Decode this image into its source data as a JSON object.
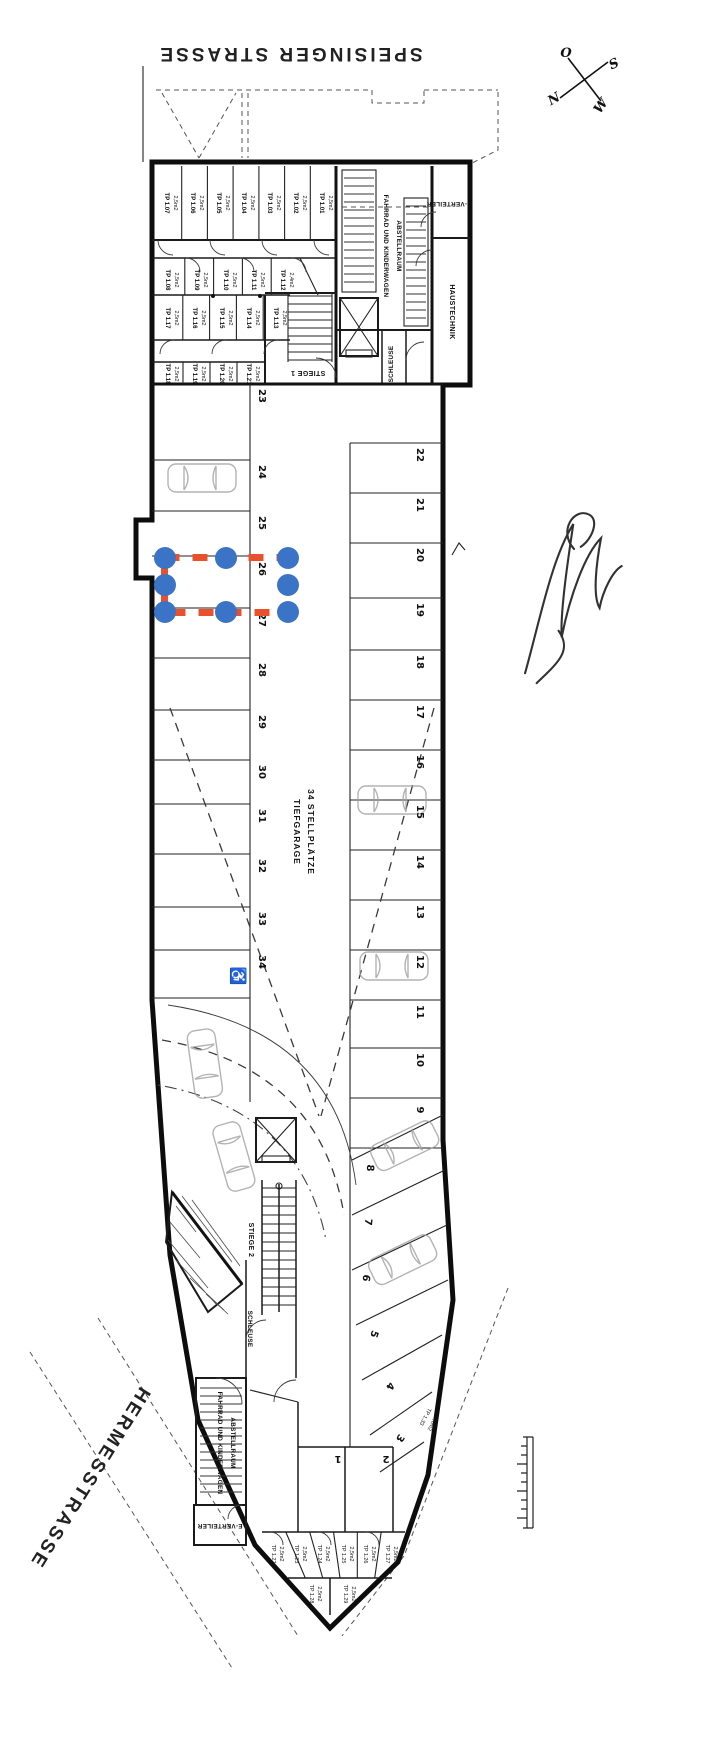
{
  "streets": {
    "top": "SPEISINGER STRASSE",
    "bottom": "HERMESSTRASSE"
  },
  "compass": {
    "north": "N",
    "south": "S",
    "east": "O",
    "west": "W"
  },
  "garage": {
    "title": "TIEFGARAGE",
    "subtitle": "34 STELLPLÄTZE"
  },
  "rooms": {
    "stiege1": "STIEGE 1",
    "stiege2": "STIEGE 2",
    "schleuse_top": "SCHLEUSE",
    "schleuse_bottom": "SCHLEUSE",
    "haustechnik": "HAUSTECHNIK",
    "e_verteiler_top": "E-VERTEILER",
    "e_verteiler_bottom": "E-VERTEILER",
    "bike_top_line1": "FAHRRAD UND KINDERWAGEN",
    "bike_top_line2": "ABSTELLRAUM",
    "bike_bottom_line1": "FAHRRAD UND KINDERWAGEN",
    "bike_bottom_line2": "ABSTELLRAUM"
  },
  "storage": {
    "row_a": [
      {
        "name": "TP 1.07",
        "size": "2,5m2"
      },
      {
        "name": "TP 1.06",
        "size": "2,5m2"
      },
      {
        "name": "TP 1.05",
        "size": "2,5m2"
      },
      {
        "name": "TP 1.04",
        "size": "2,5m2"
      },
      {
        "name": "TP 1.03",
        "size": "2,5m2"
      },
      {
        "name": "TP 1.02",
        "size": "2,5m2"
      },
      {
        "name": "TP 1.01",
        "size": "2,5m2"
      }
    ],
    "row_b": [
      {
        "name": "TP 1.08",
        "size": "2,5m2"
      },
      {
        "name": "TP 1.09",
        "size": "2,5m2"
      },
      {
        "name": "TP 1.10",
        "size": "2,5m2"
      },
      {
        "name": "TP 1.11",
        "size": "2,5m2"
      },
      {
        "name": "TP 1.12",
        "size": "2,4m2"
      }
    ],
    "row_c": [
      {
        "name": "TP 1.17",
        "size": "2,5m2"
      },
      {
        "name": "TP 1.16",
        "size": "2,5m2"
      },
      {
        "name": "TP 1.15",
        "size": "2,5m2"
      },
      {
        "name": "TP 1.14",
        "size": "2,5m2"
      },
      {
        "name": "TP 1.13",
        "size": "2,5m2"
      }
    ],
    "row_d": [
      {
        "name": "TP 1.18",
        "size": "2,5m2"
      },
      {
        "name": "TP 1.19",
        "size": "2,5m2"
      },
      {
        "name": "TP 1.20",
        "size": "2,5m2"
      },
      {
        "name": "TP 1.21",
        "size": "2,5m2"
      }
    ],
    "bottom_row": [
      {
        "name": "TP 1.22",
        "size": "2,5m2"
      },
      {
        "name": "TP 1.23",
        "size": "2,5m2"
      },
      {
        "name": "TP 1.24",
        "size": "2,5m2"
      },
      {
        "name": "TP 1.25",
        "size": "2,5m2"
      },
      {
        "name": "TP 1.26",
        "size": "2,5m2"
      },
      {
        "name": "TP 1.27",
        "size": "2,5m2"
      }
    ],
    "bottom_tip": [
      {
        "name": "TP 1.28",
        "size": "2,5m2"
      },
      {
        "name": "TP 1.29",
        "size": "2,5m2"
      }
    ],
    "side_room": {
      "name": "TP 1.33",
      "size": "5,0m2"
    }
  },
  "parking": {
    "left": [
      "23",
      "24",
      "25",
      "26",
      "27",
      "28",
      "29",
      "30",
      "31",
      "32",
      "33",
      "34"
    ],
    "right": [
      "22",
      "21",
      "20",
      "19",
      "18",
      "17",
      "16",
      "15",
      "14",
      "13",
      "12",
      "11",
      "10",
      "9"
    ],
    "angled": [
      "8",
      "7",
      "6",
      "5",
      "4",
      "3"
    ],
    "flat": [
      "2",
      "1"
    ],
    "accessible_space": "34"
  },
  "icons": {
    "wheelchair": "♿"
  },
  "annotation": {
    "selected_space": "26",
    "box_color": "#E8512C",
    "handle_color": "#3B74C6"
  }
}
